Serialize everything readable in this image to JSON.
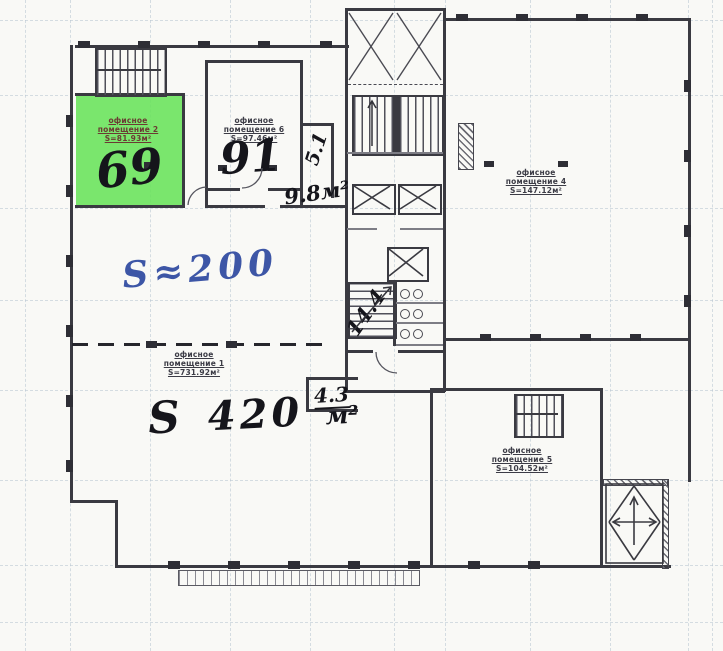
{
  "rooms": {
    "room2": {
      "name_line1": "офисное",
      "name_line2": "помещение 2",
      "area": "S=81.93м²",
      "marker": "69"
    },
    "room6": {
      "name_line1": "офисное",
      "name_line2": "помещение 6",
      "area": "S=97.46м²",
      "marker": "91"
    },
    "room4": {
      "name_line1": "офисное",
      "name_line2": "помещение 4",
      "area": "S=147.12м²"
    },
    "room5": {
      "name_line1": "офисное",
      "name_line2": "помещение 5",
      "area": "S=104.52м²"
    },
    "room1": {
      "name_line1": "офисное",
      "name_line2": "помещение 1",
      "area": "S=731.92м²"
    }
  },
  "handwritten": {
    "area_blue": "S≈200",
    "area_420_s": "S",
    "area_420_value": "420",
    "area_420_unit": "м²",
    "area_98": "9.8м²",
    "shaft": "5.1",
    "wc": "14.4",
    "tambour": "4.3"
  },
  "colors": {
    "highlight": "#68e25a",
    "blue_ink": "#3d56a6",
    "ink": "#15151b",
    "wall": "#3a3a41"
  }
}
